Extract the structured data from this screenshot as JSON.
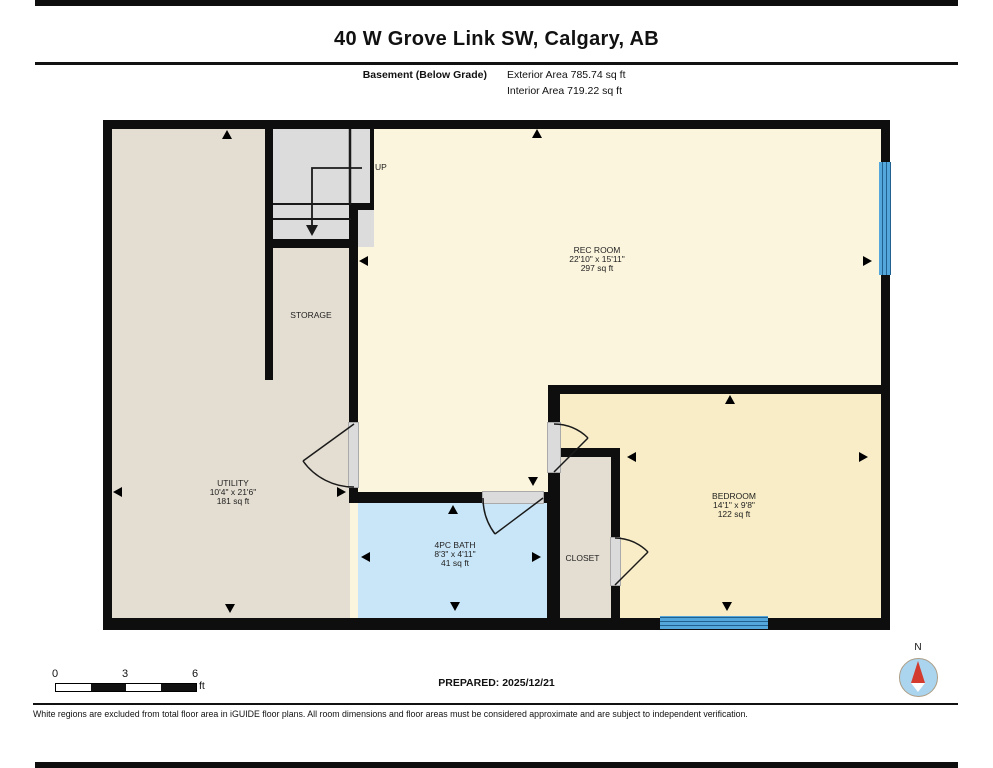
{
  "header": {
    "title": "40 W Grove Link SW, Calgary, AB",
    "floor_label": "Basement (Below Grade)",
    "exterior_area": "Exterior Area 785.74 sq ft",
    "interior_area": "Interior Area 719.22 sq ft"
  },
  "rooms": {
    "rec_room": {
      "name": "REC ROOM",
      "dimensions": "22'10\" x 15'11\"",
      "area": "297 sq ft"
    },
    "storage": {
      "name": "STORAGE"
    },
    "utility": {
      "name": "UTILITY",
      "dimensions": "10'4\" x 21'6\"",
      "area": "181 sq ft"
    },
    "bath": {
      "name": "4PC BATH",
      "dimensions": "8'3\" x 4'11\"",
      "area": "41 sq ft"
    },
    "closet": {
      "name": "CLOSET"
    },
    "bedroom": {
      "name": "BEDROOM",
      "dimensions": "14'1\" x 9'8\"",
      "area": "122 sq ft"
    },
    "stairs": {
      "direction_label": "UP"
    }
  },
  "scale_bar": {
    "ticks": [
      "0",
      "3",
      "6"
    ],
    "unit": "ft"
  },
  "compass": {
    "north_label": "N"
  },
  "footer": {
    "prepared": "PREPARED: 2025/12/21",
    "disclaimer": "White regions are excluded from total floor area in iGUIDE floor plans. All room dimensions and floor areas must be considered approximate and are subject to independent verification."
  },
  "colors": {
    "wall": "#0e0e0e",
    "room_beige": "#e4ddd1",
    "rec_room_yellow": "#fbf5dd",
    "bedroom_yellow": "#f8edc6",
    "bath_blue": "#c9e6f8",
    "stairs_gray": "#dcdcdc",
    "window_blue": "#54a7da",
    "compass_red": "#d23b2e"
  }
}
